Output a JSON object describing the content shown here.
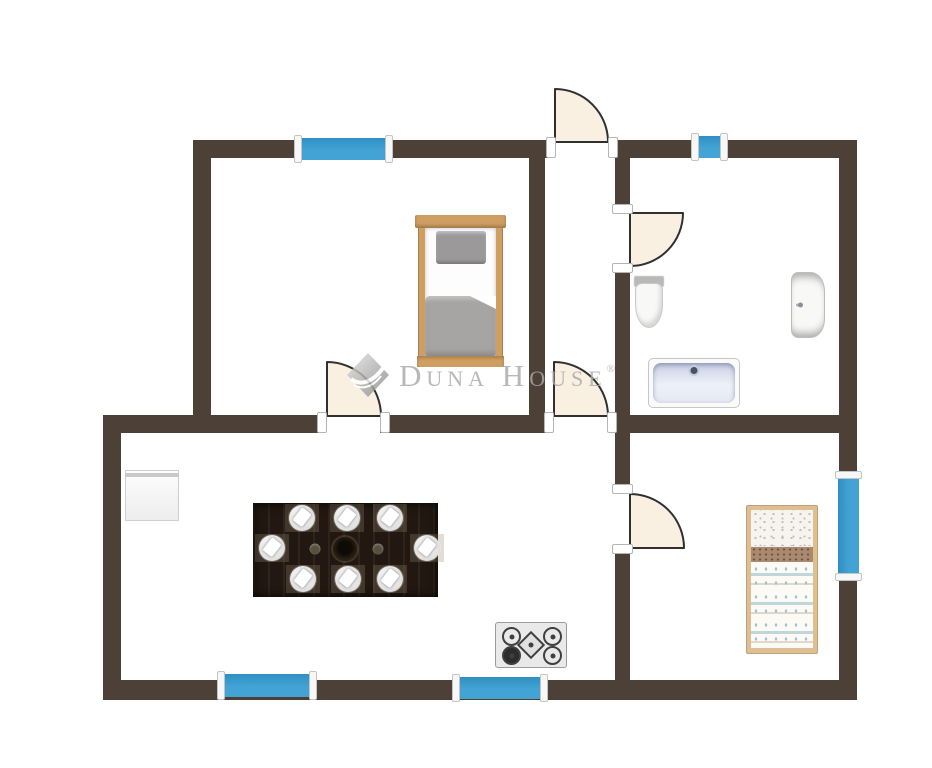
{
  "watermark": {
    "brand": "Duna House",
    "registered_mark": "®"
  },
  "palette": {
    "floor": "#ffffff",
    "wall": "#4d4137",
    "window_blue": "#44a3d5",
    "window_blue_deep": "#2e8fc2",
    "window_cap": "#f7f7f7",
    "door_fill": "#faf0e1",
    "door_line": "#303030",
    "watermark_gray": "#a9a9a9",
    "wood": "#cf9e61",
    "wood_light": "#dfbe92",
    "mattress_white": "#fdfdfd",
    "duvet_gray": "#a7a5a3",
    "pillow_gray": "#9b9999",
    "child_band_brown": "#a98a6e",
    "child_blanket_blue": "#9dc2d2",
    "ceramic_white": "#f8f8f6",
    "tub_inner": "#eef1f9",
    "appliance_white": "#ededed",
    "table_dark": "#221811",
    "plate_white": "#f4f4f4",
    "stove_body": "#e9e9e9",
    "stove_dark": "#3f3f3f"
  },
  "inventory": {
    "furniture": [
      "single-bed",
      "toilet",
      "washbasin",
      "bathtub",
      "refrigerator",
      "dining-table-8-settings",
      "gas-hob",
      "child-bed"
    ],
    "window_count": 5,
    "door_count": 5
  }
}
